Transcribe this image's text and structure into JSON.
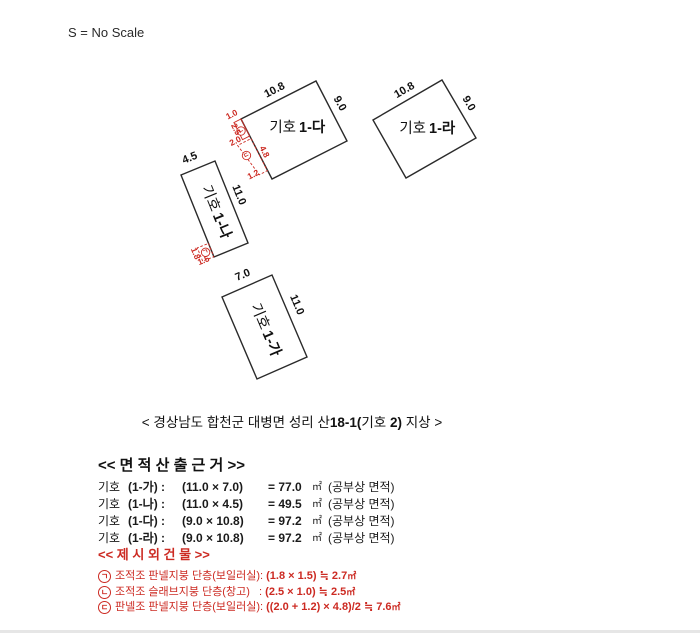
{
  "scale_note": "S = No Scale",
  "colors": {
    "red": "#cc2a22",
    "black": "#1a1a1a"
  },
  "diagram": {
    "buildings": [
      {
        "label_prefix": "기호",
        "label_bold": "1-가",
        "dim_top": "7.0",
        "dim_side": "11.0"
      },
      {
        "label_prefix": "기호",
        "label_bold": "1-나",
        "dim_top": "4.5",
        "dim_side": "11.0"
      },
      {
        "label_prefix": "기호",
        "label_bold": "1-다",
        "dim_top": "10.8",
        "dim_side": "9.0"
      },
      {
        "label_prefix": "기호",
        "label_bold": "1-라",
        "dim_top": "10.8",
        "dim_side": "9.0"
      }
    ],
    "annotations": [
      {
        "marker": "ㄱ",
        "dims": [
          "1.8",
          "1.5"
        ]
      },
      {
        "marker": "ㄴ",
        "dims": [
          "1.0",
          "2.5"
        ]
      },
      {
        "marker": "ㄷ",
        "dims": [
          "2.0",
          "4.8",
          "1.2"
        ]
      }
    ]
  },
  "caption": {
    "pre": "< 경상남도 합천군 대병면 성리 산",
    "b1": "18-1(",
    "mid": "기호 ",
    "b2": "2)",
    "post": " 지상 >"
  },
  "area_section": {
    "header": "<< 면 적 산 출 근 거 >>",
    "rows": [
      {
        "prefix": "기호",
        "id": "(1-가) :",
        "expr": "(11.0 × 7.0)",
        "result": "= 77.0",
        "unit": "㎡",
        "note": "(공부상 면적)"
      },
      {
        "prefix": "기호",
        "id": "(1-나) :",
        "expr": "(11.0 × 4.5)",
        "result": "= 49.5",
        "unit": "㎡",
        "note": "(공부상 면적)"
      },
      {
        "prefix": "기호",
        "id": "(1-다) :",
        "expr": "(9.0 × 10.8)",
        "result": "= 97.2",
        "unit": "㎡",
        "note": "(공부상 면적)"
      },
      {
        "prefix": "기호",
        "id": "(1-라) :",
        "expr": "(9.0 × 10.8)",
        "result": "= 97.2",
        "unit": "㎡",
        "note": "(공부상 면적)"
      }
    ]
  },
  "extra_section": {
    "header": "<< 제 시 외 건 물 >>",
    "rows": [
      {
        "marker": "ㄱ",
        "desc": "조적조 판넬지붕 단층(보일러실): ",
        "formula": "(1.8 × 1.5) ≒ 2.7",
        "unit": "㎡"
      },
      {
        "marker": "ㄴ",
        "desc": "조적조 슬래브지붕 단층(창고)   : ",
        "formula": "(2.5 × 1.0) ≒ 2.5",
        "unit": "㎡"
      },
      {
        "marker": "ㄷ",
        "desc": "판넬조 판넬지붕 단층(보일러실): ",
        "formula": "((2.0 + 1.2) × 4.8)/2 ≒ 7.6",
        "unit": "㎡"
      }
    ]
  }
}
